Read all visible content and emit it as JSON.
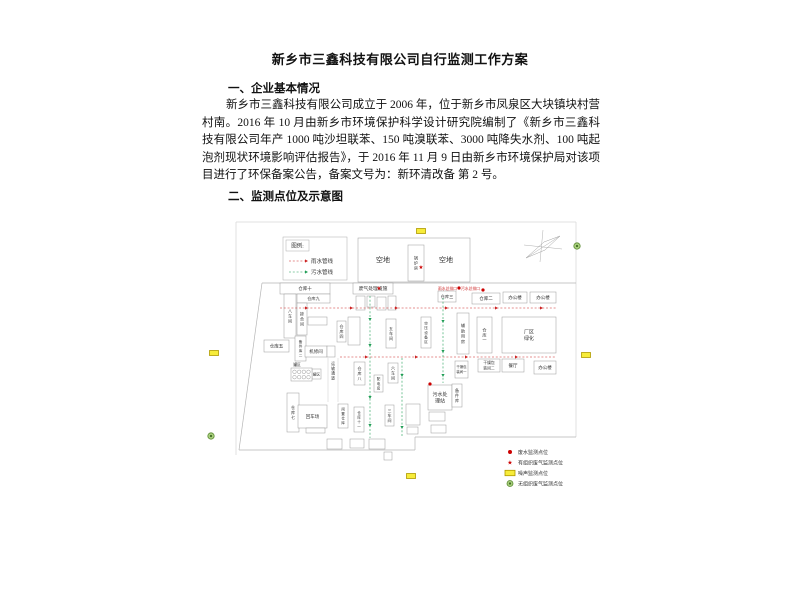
{
  "doc": {
    "title": "新乡市三鑫科技有限公司自行监测工作方案",
    "section1_heading": "一、企业基本情况",
    "paragraph": "新乡市三鑫科技有限公司成立于 2006 年，位于新乡市凤泉区大块镇块村营村南。2016 年 10 月由新乡市环境保护科学设计研究院编制了《新乡市三鑫科技有限公司年产 1000 吨沙坦联苯、150 吨溴联苯、3000 吨降失水剂、100 吨起泡剂现状环境影响评估报告》，于 2016 年 11 月 9 日由新乡市环境保护局对该项目进行了环保备案公告，备案文号为：新环清改备 第 2 号。",
    "section2_heading": "二、监测点位及示意图"
  },
  "diagram": {
    "colors": {
      "rain": "#cc2222",
      "sewage": "#1f9d55",
      "noise_fill": "#f7ec3a",
      "noise_stroke": "#b09a00",
      "gas_fill": "#a8ce7c",
      "gas_stroke": "#5d8c35",
      "gas_core": "#3f6b22",
      "marker_red": "#cc0000",
      "text": "#333333",
      "box_stroke": "#999999"
    },
    "lines": [
      {
        "pts": [
          [
            236,
            222
          ],
          [
            576,
            222
          ]
        ],
        "c": "#d9d9d9",
        "w": 0.8
      },
      {
        "pts": [
          [
            236,
            222
          ],
          [
            236,
            455
          ]
        ],
        "c": "#d9d9d9",
        "w": 0.8
      },
      {
        "pts": [
          [
            576,
            222
          ],
          [
            576,
            437
          ]
        ],
        "c": "#d9d9d9",
        "w": 0.8
      },
      {
        "pts": [
          [
            262,
            283
          ],
          [
            576,
            283
          ]
        ],
        "c": "#b5b5b5",
        "w": 0.7
      },
      {
        "pts": [
          [
            262,
            283
          ],
          [
            239,
            450
          ]
        ],
        "c": "#b5b5b5",
        "w": 0.7
      },
      {
        "pts": [
          [
            239,
            450
          ],
          [
            415,
            450
          ]
        ],
        "c": "#b5b5b5",
        "w": 0.7
      },
      {
        "pts": [
          [
            415,
            450
          ],
          [
            415,
            437
          ]
        ],
        "c": "#b5b5b5",
        "w": 0.7
      },
      {
        "pts": [
          [
            415,
            437
          ],
          [
            576,
            437
          ]
        ],
        "c": "#b5b5b5",
        "w": 0.7
      },
      {
        "pts": [
          [
            328,
            358
          ],
          [
            328,
            402
          ]
        ],
        "c": "#c9c9c9",
        "w": 0.5
      },
      {
        "pts": [
          [
            338,
            358
          ],
          [
            338,
            402
          ]
        ],
        "c": "#c9c9c9",
        "w": 0.5
      }
    ],
    "legend_pipes": {
      "box": [
        283,
        237,
        64,
        43
      ],
      "title_box": [
        286,
        240,
        23,
        11
      ],
      "title": "图例:",
      "line_x": [
        289,
        305
      ],
      "label_x": 311,
      "rows": [
        {
          "label": "雨水管线",
          "color_key": "rain",
          "y": 261
        },
        {
          "label": "污水管线",
          "color_key": "sewage",
          "y": 272
        }
      ]
    },
    "buildings": [
      {
        "x": 358,
        "y": 238,
        "w": 112,
        "h": 44,
        "label": ""
      },
      {
        "x": 408,
        "y": 245,
        "w": 16,
        "h": 36,
        "label": "锅炉房",
        "v": true,
        "fs": 4
      },
      {
        "x": 280,
        "y": 283,
        "w": 50,
        "h": 11,
        "label": "仓库十"
      },
      {
        "x": 297,
        "y": 294,
        "w": 33,
        "h": 9,
        "label": "仓库九",
        "fs": 4.2
      },
      {
        "x": 284,
        "y": 294,
        "w": 12,
        "h": 44,
        "label": "八车间",
        "v": true
      },
      {
        "x": 297,
        "y": 303,
        "w": 10,
        "h": 32,
        "label": "掺合间",
        "v": true,
        "fs": 4
      },
      {
        "x": 308,
        "y": 317,
        "w": 19,
        "h": 8,
        "label": ""
      },
      {
        "x": 295,
        "y": 336,
        "w": 11,
        "h": 25,
        "label": "备件库二",
        "v": true,
        "fs": 3.6
      },
      {
        "x": 264,
        "y": 340,
        "w": 25,
        "h": 12,
        "label": "仓库五"
      },
      {
        "x": 305,
        "y": 346,
        "w": 22,
        "h": 11,
        "label": "机修间"
      },
      {
        "x": 327,
        "y": 346,
        "w": 8,
        "h": 11,
        "label": ""
      },
      {
        "x": 312,
        "y": 369,
        "w": 9,
        "h": 10,
        "label": "罐区",
        "fs": 3.6
      },
      {
        "x": 287,
        "y": 393,
        "w": 12,
        "h": 39,
        "label": "仓库七",
        "v": true
      },
      {
        "x": 298,
        "y": 405,
        "w": 29,
        "h": 23,
        "label": "回车场"
      },
      {
        "x": 306,
        "y": 428,
        "w": 19,
        "h": 5,
        "label": ""
      },
      {
        "x": 353,
        "y": 283,
        "w": 40,
        "h": 11,
        "label": "废气处理设施",
        "fs": 4.8
      },
      {
        "x": 356,
        "y": 296,
        "w": 9,
        "h": 14,
        "label": ""
      },
      {
        "x": 367,
        "y": 296,
        "w": 8,
        "h": 11,
        "label": ""
      },
      {
        "x": 377,
        "y": 297,
        "w": 9,
        "h": 13,
        "label": ""
      },
      {
        "x": 388,
        "y": 296,
        "w": 8,
        "h": 14,
        "label": ""
      },
      {
        "x": 337,
        "y": 321,
        "w": 9,
        "h": 21,
        "label": "仓库四",
        "v": true,
        "fs": 4
      },
      {
        "x": 348,
        "y": 317,
        "w": 12,
        "h": 28,
        "label": ""
      },
      {
        "x": 386,
        "y": 319,
        "w": 10,
        "h": 29,
        "label": "五车间",
        "v": true,
        "fs": 4
      },
      {
        "x": 421,
        "y": 317,
        "w": 10,
        "h": 31,
        "label": "空压设备区",
        "v": true,
        "fs": 3.6
      },
      {
        "x": 457,
        "y": 313,
        "w": 12,
        "h": 41,
        "label": "辅助用房",
        "v": true,
        "fs": 4.2
      },
      {
        "x": 477,
        "y": 317,
        "w": 15,
        "h": 36,
        "label": "仓库一",
        "v": true,
        "fs": 4.2
      },
      {
        "x": 502,
        "y": 317,
        "w": 54,
        "h": 36,
        "label": "厂区\n绿化",
        "fs": 5
      },
      {
        "x": 438,
        "y": 291,
        "w": 18,
        "h": 11,
        "label": "仓库三",
        "fs": 4.2
      },
      {
        "x": 472,
        "y": 293,
        "w": 28,
        "h": 11,
        "label": "仓库二",
        "fs": 4.5
      },
      {
        "x": 503,
        "y": 292,
        "w": 24,
        "h": 11,
        "label": "办公楼",
        "fs": 4.5
      },
      {
        "x": 530,
        "y": 292,
        "w": 26,
        "h": 11,
        "label": "办公楼",
        "fs": 4.5
      },
      {
        "x": 374,
        "y": 375,
        "w": 9,
        "h": 17,
        "label": "配电房",
        "v": true,
        "fs": 3.6
      },
      {
        "x": 388,
        "y": 363,
        "w": 10,
        "h": 20,
        "label": "六车间",
        "v": true,
        "fs": 4
      },
      {
        "x": 354,
        "y": 362,
        "w": 11,
        "h": 23,
        "label": "仓库八",
        "v": true,
        "fs": 4
      },
      {
        "x": 338,
        "y": 404,
        "w": 10,
        "h": 24,
        "label": "闲置仓库",
        "v": true,
        "fs": 3.6
      },
      {
        "x": 354,
        "y": 407,
        "w": 10,
        "h": 25,
        "label": "仓库十一",
        "v": true,
        "fs": 3.6
      },
      {
        "x": 385,
        "y": 405,
        "w": 9,
        "h": 21,
        "label": "三车间",
        "v": true,
        "fs": 4
      },
      {
        "x": 327,
        "y": 439,
        "w": 15,
        "h": 10,
        "label": ""
      },
      {
        "x": 350,
        "y": 439,
        "w": 14,
        "h": 9,
        "label": ""
      },
      {
        "x": 369,
        "y": 439,
        "w": 16,
        "h": 10,
        "label": ""
      },
      {
        "x": 384,
        "y": 452,
        "w": 8,
        "h": 8,
        "label": ""
      },
      {
        "x": 406,
        "y": 404,
        "w": 14,
        "h": 21,
        "label": ""
      },
      {
        "x": 407,
        "y": 427,
        "w": 11,
        "h": 7,
        "label": ""
      },
      {
        "x": 429,
        "y": 412,
        "w": 16,
        "h": 9,
        "label": ""
      },
      {
        "x": 431,
        "y": 425,
        "w": 15,
        "h": 8,
        "label": ""
      },
      {
        "x": 428,
        "y": 385,
        "w": 24,
        "h": 25,
        "label": "污水处\n理站",
        "fs": 5
      },
      {
        "x": 452,
        "y": 384,
        "w": 10,
        "h": 23,
        "label": "备件库",
        "v": true,
        "fs": 4
      },
      {
        "x": 455,
        "y": 361,
        "w": 13,
        "h": 17,
        "label": "干燥包\n装间一",
        "fs": 3.4
      },
      {
        "x": 478,
        "y": 359,
        "w": 22,
        "h": 13,
        "label": "干燥包\n装间二",
        "fs": 3.8
      },
      {
        "x": 502,
        "y": 359,
        "w": 22,
        "h": 13,
        "label": "餐厅",
        "fs": 4.5
      },
      {
        "x": 534,
        "y": 361,
        "w": 22,
        "h": 13,
        "label": "办公楼",
        "fs": 4.5
      }
    ],
    "tanks": {
      "x": 291,
      "y": 368,
      "w": 21,
      "h": 13,
      "rows": 2,
      "cols": 4
    },
    "free_texts": [
      {
        "x": 383,
        "y": 262,
        "t": "空地",
        "fs": 7
      },
      {
        "x": 446,
        "y": 262,
        "t": "空地",
        "fs": 7
      },
      {
        "x": 333,
        "y": 365,
        "t": "运输通道",
        "fs": 3.8,
        "v": true
      },
      {
        "x": 297,
        "y": 366,
        "t": "罐区",
        "fs": 3.8
      }
    ],
    "red_texts": [
      {
        "x": 438,
        "y": 290,
        "t": "雨水总排口",
        "fs": 3.8
      },
      {
        "x": 461,
        "y": 290,
        "t": "污水总排口",
        "fs": 3.8
      }
    ],
    "markers": {
      "stars": [
        [
          379,
          288
        ],
        [
          421,
          267
        ]
      ],
      "dots": [
        [
          459,
          288
        ],
        [
          483,
          290
        ],
        [
          430,
          384
        ]
      ],
      "noise": [
        [
          214,
          353
        ],
        [
          421,
          231
        ],
        [
          586,
          355
        ],
        [
          411,
          476
        ]
      ],
      "gas": [
        [
          211,
          436
        ],
        [
          577,
          246
        ]
      ]
    },
    "pipelines": [
      {
        "color_key": "rain",
        "pts": [
          [
            280,
            308
          ],
          [
            556,
            308
          ]
        ],
        "arrows": [
          [
            305,
            308,
            "r"
          ],
          [
            350,
            308,
            "r"
          ],
          [
            395,
            308,
            "r"
          ],
          [
            445,
            308,
            "r"
          ],
          [
            495,
            308,
            "r"
          ],
          [
            540,
            308,
            "r"
          ]
        ]
      },
      {
        "color_key": "rain",
        "pts": [
          [
            340,
            357
          ],
          [
            556,
            357
          ]
        ],
        "arrows": [
          [
            365,
            357,
            "r"
          ],
          [
            415,
            357,
            "r"
          ],
          [
            465,
            357,
            "r"
          ],
          [
            515,
            357,
            "r"
          ]
        ]
      },
      {
        "color_key": "sewage",
        "pts": [
          [
            370,
            296
          ],
          [
            370,
            438
          ]
        ],
        "arrows": [
          [
            370,
            318,
            "d"
          ],
          [
            370,
            344,
            "d"
          ],
          [
            370,
            396,
            "d"
          ],
          [
            370,
            424,
            "d"
          ]
        ]
      },
      {
        "color_key": "sewage",
        "pts": [
          [
            443,
            298
          ],
          [
            443,
            383
          ]
        ],
        "arrows": [
          [
            443,
            320,
            "d"
          ],
          [
            443,
            350,
            "d"
          ],
          [
            443,
            374,
            "d"
          ]
        ]
      },
      {
        "color_key": "sewage",
        "pts": [
          [
            402,
            358
          ],
          [
            402,
            436
          ]
        ],
        "arrows": [
          [
            402,
            374,
            "d"
          ],
          [
            402,
            426,
            "d"
          ]
        ]
      }
    ],
    "compass": {
      "lines": [
        [
          [
            526,
            258
          ],
          [
            560,
            236
          ]
        ],
        [
          [
            543,
            230
          ],
          [
            540,
            262
          ]
        ],
        [
          [
            524,
            245
          ],
          [
            562,
            249
          ]
        ]
      ],
      "poly": [
        [
          526,
          258
        ],
        [
          544,
          242
        ],
        [
          560,
          236
        ],
        [
          545,
          250
        ]
      ]
    },
    "legend_points": {
      "x_sym": 510,
      "x_label": 518,
      "rows": [
        {
          "sym": "dot",
          "label": "废水监测点位",
          "y": 452
        },
        {
          "sym": "star",
          "label": "有组织废气监测点位",
          "y": 462.5
        },
        {
          "sym": "noise",
          "label": "噪声监测点位",
          "y": 473
        },
        {
          "sym": "gas",
          "label": "无组织废气监测点位",
          "y": 483.5
        }
      ]
    }
  }
}
